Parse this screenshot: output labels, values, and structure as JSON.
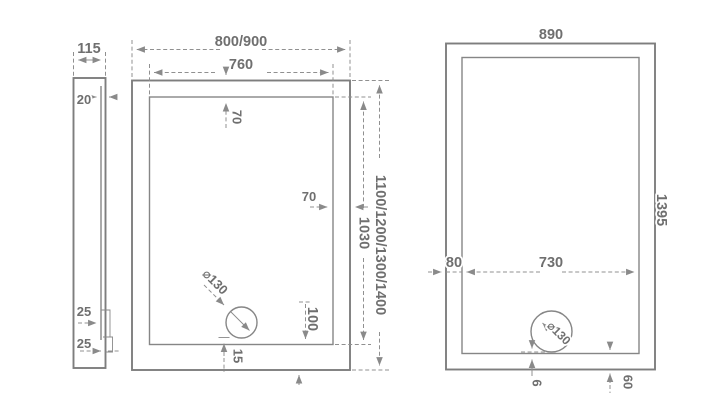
{
  "drawing_title": "shower-tray-dimension-drawing",
  "colors": {
    "outline": "#7e7e7e",
    "inner_line": "#868686",
    "dimension": "#909090",
    "text": "#6f6f6f",
    "background": "#ffffff"
  },
  "side_profile": {
    "width": "115",
    "wall_thickness": "20",
    "step_upper": "25",
    "step_lower": "25"
  },
  "plan_main": {
    "outer_width": "800/900",
    "inner_width": "760",
    "rim_top": "70",
    "rim_side": "70",
    "inner_length": "1030",
    "outer_length": "1100/1200/1300/1400",
    "drain_diameter": "⌀130",
    "drain_center_to_edge": "100",
    "drain_to_inner_edge": "15"
  },
  "plan_890": {
    "outer_width": "890",
    "outer_length": "1395",
    "rim_left": "80",
    "inner_width": "730",
    "drain_diameter": "⌀130",
    "drain_bottom_gap": "6",
    "rim_bottom": "60"
  }
}
